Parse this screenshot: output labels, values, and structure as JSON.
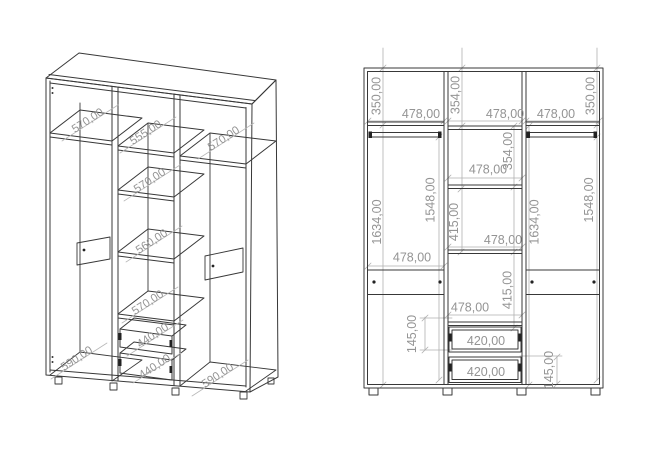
{
  "drawing": {
    "type": "furniture-technical-drawing",
    "subject": "three-door wardrobe with shelves and two drawers",
    "colors": {
      "background": "#ffffff",
      "cabinet_line": "#383838",
      "dimension_line": "#b0b0b0",
      "dimension_text": "#949494"
    }
  },
  "isometric_view": {
    "labels": [
      "570,00",
      "555,00",
      "570,00",
      "570,00",
      "560,00",
      "570,00",
      "440,00",
      "440,00",
      "590,00",
      "590,00"
    ]
  },
  "front_view": {
    "labels": [
      "350,00",
      "478,00",
      "354,00",
      "478,00",
      "478,00",
      "350,00",
      "354,00",
      "478,00",
      "1634,00",
      "1548,00",
      "415,00",
      "478,00",
      "1634,00",
      "1548,00",
      "478,00",
      "415,00",
      "478,00",
      "145,00",
      "420,00",
      "420,00",
      "145,00"
    ]
  }
}
